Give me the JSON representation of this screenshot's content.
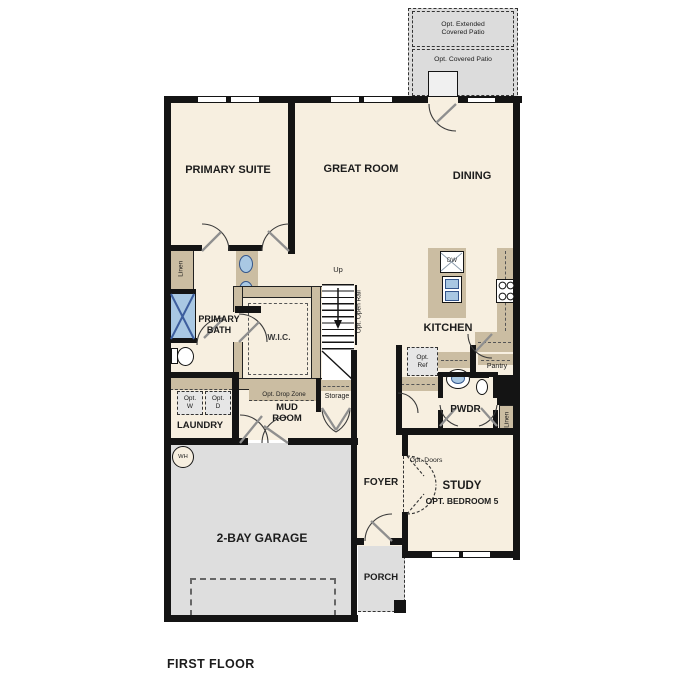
{
  "title": "FIRST FLOOR",
  "patio": {
    "extended": "Opt. Extended Covered Patio",
    "covered": "Opt. Covered Patio"
  },
  "rooms": {
    "primary_suite": "PRIMARY SUITE",
    "great_room": "GREAT ROOM",
    "dining": "DINING",
    "kitchen": "KITCHEN",
    "primary_bath": "PRIMARY BATH",
    "wic": "W.I.C.",
    "laundry": "LAUNDRY",
    "mud_room": "MUD ROOM",
    "storage": "Storage",
    "pantry": "Pantry",
    "pwdr": "PWDR",
    "foyer": "FOYER",
    "study": "STUDY",
    "study_opt": "OPT. BEDROOM 5",
    "garage": "2-BAY GARAGE",
    "porch": "PORCH"
  },
  "labels": {
    "linen_left": "Linen",
    "linen_right": "Linen",
    "up": "Up",
    "opt_open_rail": "Opt. Open Rail",
    "dw": "DW",
    "wh": "WH",
    "opt_w": "Opt. W",
    "opt_d": "Opt. D",
    "opt_ref": "Opt. Ref",
    "opt_drop_zone": "Opt. Drop Zone",
    "opt_doors": "Opt. Doors"
  },
  "colors": {
    "floor": "#f7efe0",
    "hard_surface": "#dedede",
    "counter_tan": "#cbbda2",
    "wall": "#141414",
    "fixture_blue": "#a9c8e3"
  }
}
